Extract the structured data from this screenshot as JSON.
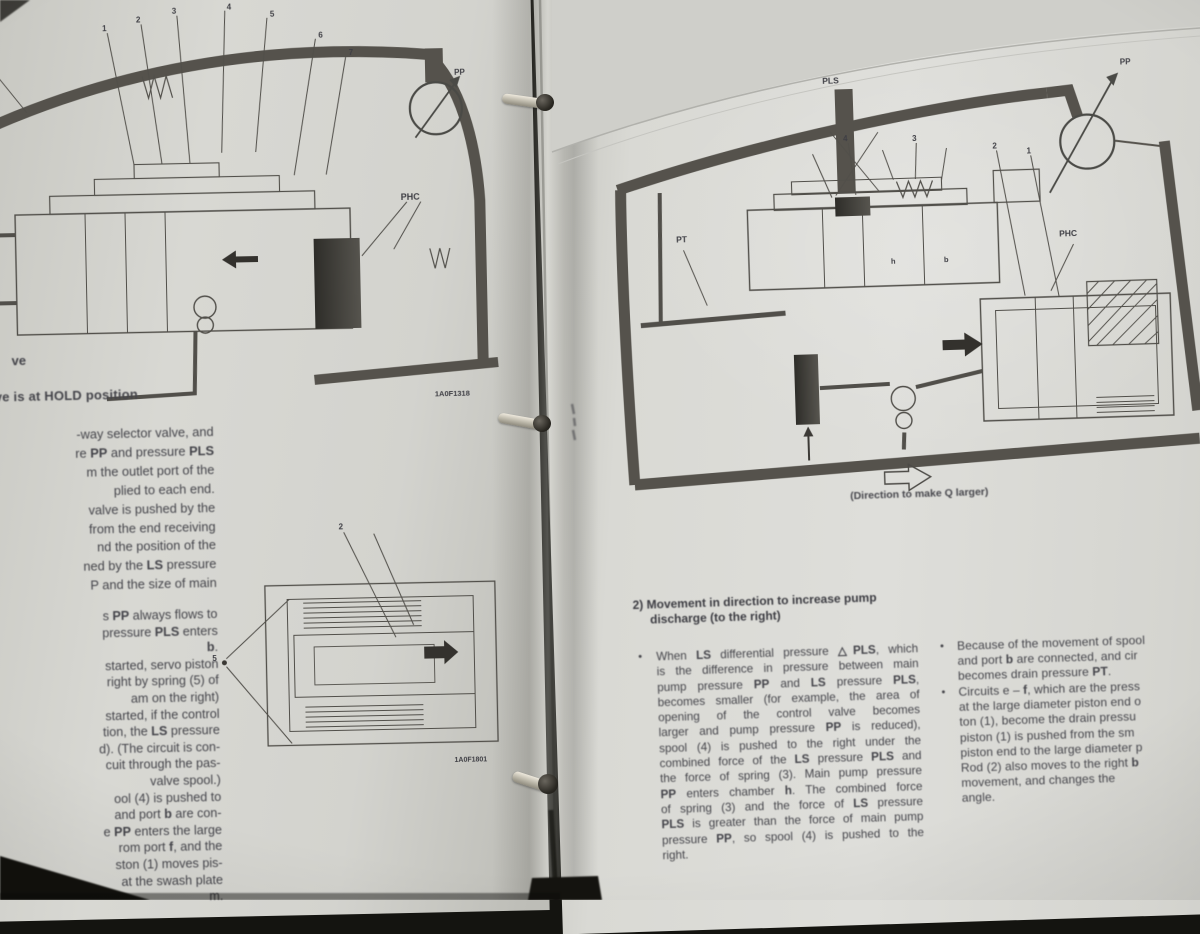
{
  "bold_tokens": [
    "△PLS",
    "PLS",
    "PP",
    "PT",
    "LS",
    "PHC",
    "HOLD",
    "Q",
    "b",
    "f",
    "h"
  ],
  "left_page": {
    "fig_top": {
      "pt_fragment": "T",
      "phc_label": "PHC",
      "pp_label": "PP",
      "fig_code": "1A0F1318",
      "callouts": [
        "1",
        "2",
        "3",
        "4",
        "5",
        "6",
        "7"
      ]
    },
    "text": {
      "frag_lead": "ve",
      "heading": "ve is at HOLD position",
      "para1_lines": [
        "-way selector valve, and",
        "re PP and pressure PLS",
        "m the outlet port of the",
        "plied to each end.",
        "valve is pushed by the",
        "from the end receiving",
        "nd the position of the",
        "ned by the LS pressure",
        "P and the size of main"
      ],
      "para2_lines": [
        "s PP always flows to",
        "pressure PLS enters",
        "b.",
        "started, servo piston",
        "right by spring (5) of",
        "am on the right)",
        "started, if the control",
        "tion, the LS pressure",
        "d). (The circuit is con-",
        "cuit through the pas-",
        "valve spool.)",
        "ool (4) is pushed to",
        "and port b are con-",
        "e PP enters the large",
        "rom port f, and the",
        "ston (1) moves pis-",
        "at the swash plate",
        "m."
      ]
    },
    "fig_bottom": {
      "fig_code": "1A0F1801",
      "label_5": "5",
      "callout_2": "2"
    }
  },
  "right_page": {
    "figure": {
      "pls_label": "PLS",
      "pp_label": "PP",
      "pt_label": "PT",
      "phc_label": "PHC",
      "port_h": "h",
      "port_b": "b",
      "callout_1": "1",
      "callout_2": "2",
      "callout_3": "3",
      "callout_4": "4"
    },
    "caption": "(Direction to make Q larger)",
    "section": {
      "heading_line1": "2) Movement in direction to increase pump",
      "heading_line2": "discharge (to the right)",
      "bullet": "•"
    },
    "paragraph_lines": [
      "When LS differential pressure △PLS, which",
      "is the difference in pressure between main",
      "pump pressure PP and LS pressure PLS,",
      "becomes smaller (for example, the area of",
      "opening of the control valve becomes",
      "larger and pump pressure PP is reduced),",
      "spool (4) is pushed to the right under the",
      "combined force of the LS pressure PLS and",
      "the force of spring (3). Main pump pressure",
      "PP enters chamber h. The combined force",
      "of spring (3) and the force of LS pressure",
      "PLS is greater than the force of main pump",
      "pressure PP, so spool (4) is pushed to the",
      "right."
    ],
    "rcol_bullet1_lines": [
      "Because of the movement of spool",
      "and port b are connected, and cir",
      "becomes drain pressure PT."
    ],
    "rcol_bullet2_lines": [
      "Circuits e – f, which are the press",
      "at the large diameter piston end o",
      "ton (1), become the drain pressu",
      "piston (1) is pushed from the sm",
      "piston end to the large diameter p",
      "Rod (2) also moves to the right b",
      "movement, and changes the",
      "angle."
    ]
  }
}
